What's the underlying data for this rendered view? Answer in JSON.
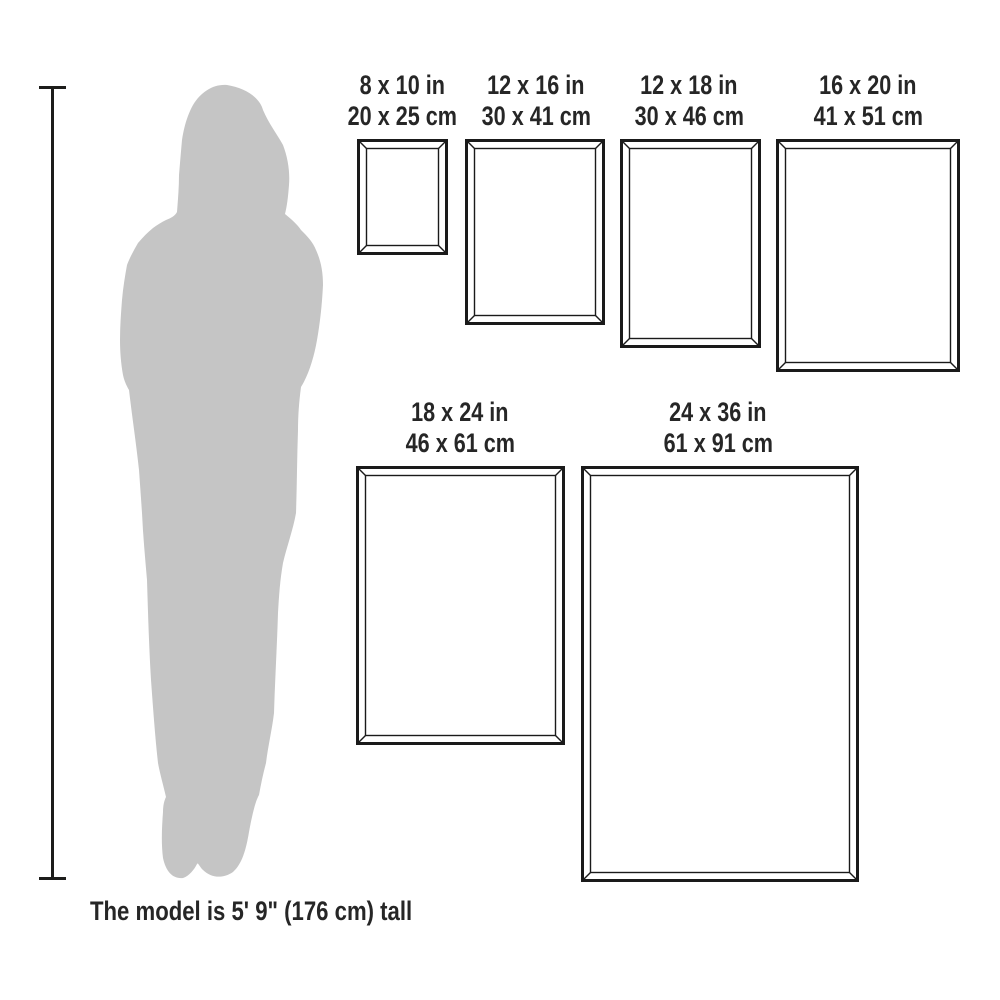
{
  "title": "Frame size comparison with human figure",
  "caption": {
    "text": "The model is 5' 9\" (176 cm) tall"
  },
  "colors": {
    "background": "#ffffff",
    "silhouette": "#c5c5c5",
    "scale_line": "#1d1d1b",
    "frame_stroke": "#1a1a1a",
    "text": "#262626"
  },
  "frames": [
    {
      "id": "8x10",
      "label_in": "8 x 10 in",
      "label_cm": "20 x 25 cm",
      "x": 357,
      "y": 139,
      "w": 91,
      "h": 116,
      "label_cx": 402
    },
    {
      "id": "12x16",
      "label_in": "12 x 16 in",
      "label_cm": "30 x 41 cm",
      "x": 465,
      "y": 139,
      "w": 140,
      "h": 186,
      "label_cx": 536
    },
    {
      "id": "12x18",
      "label_in": "12 x 18 in",
      "label_cm": "30 x 46 cm",
      "x": 620,
      "y": 139,
      "w": 141,
      "h": 209,
      "label_cx": 689
    },
    {
      "id": "16x20",
      "label_in": "16 x 20 in",
      "label_cm": "41 x 51 cm",
      "x": 776,
      "y": 139,
      "w": 184,
      "h": 233,
      "label_cx": 868
    },
    {
      "id": "18x24",
      "label_in": "18 x 24 in",
      "label_cm": "46 x 61 cm",
      "x": 356,
      "y": 466,
      "w": 209,
      "h": 279,
      "label_cx": 460
    },
    {
      "id": "24x36",
      "label_in": "24 x 36 in",
      "label_cm": "61 x 91 cm",
      "x": 581,
      "y": 466,
      "w": 278,
      "h": 416,
      "label_cx": 718
    }
  ],
  "frame_style": {
    "outer_stroke": 3,
    "inner_stroke": 1.4,
    "bevel": 8
  }
}
